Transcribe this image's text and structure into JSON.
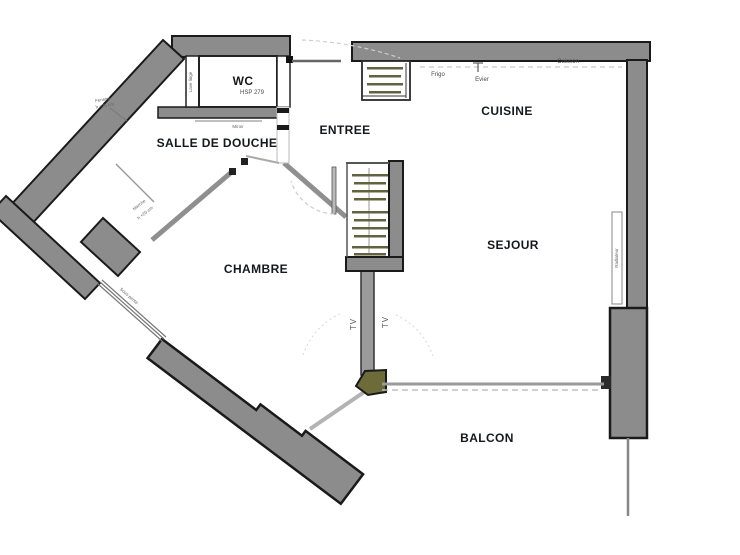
{
  "rooms": [
    {
      "id": "wc",
      "label": "WC"
    },
    {
      "id": "salle-de-douche",
      "label": "SALLE DE DOUCHE"
    },
    {
      "id": "entree",
      "label": "ENTREE"
    },
    {
      "id": "cuisine",
      "label": "CUISINE"
    },
    {
      "id": "chambre",
      "label": "CHAMBRE"
    },
    {
      "id": "sejour",
      "label": "SEJOUR"
    },
    {
      "id": "balcon",
      "label": "BALCON"
    }
  ],
  "annotations": {
    "wc_height": "HSP 279",
    "fridge": "Frigo",
    "sink": "Evier",
    "cooktop": "Cuisson",
    "mirror": "Miroir",
    "laundry": "Lave linge",
    "window_note_1": "Fenetre",
    "window_note_2": "h +25 cm",
    "step_note_1": "Marche",
    "step_note_2": "h +20 cm",
    "slope_note": "Sous pente",
    "radiator": "Radiateur",
    "tv_left": "TV",
    "tv_right": "TV"
  },
  "colors": {
    "wall_fill": "#8c8c8c",
    "wall_outline": "#1a1a1a",
    "thin_wall": "#8f8f8f",
    "column_fill": "#6e6b3a",
    "hanger_bar": "#62623e",
    "label_color": "#15181c"
  }
}
